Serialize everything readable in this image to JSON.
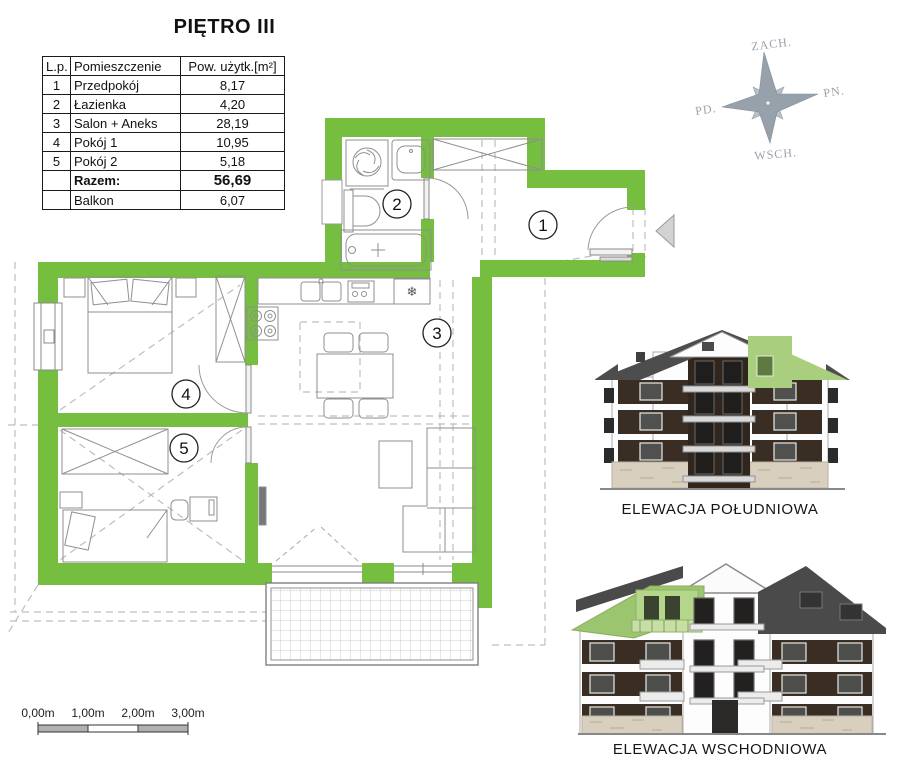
{
  "title": "PIĘTRO III",
  "table": {
    "headers": [
      "L.p.",
      "Pomieszczenie",
      "Pow. użytk.[m²]"
    ],
    "rows": [
      {
        "lp": "1",
        "name": "Przedpokój",
        "area": "8,17"
      },
      {
        "lp": "2",
        "name": "Łazienka",
        "area": "4,20"
      },
      {
        "lp": "3",
        "name": "Salon + Aneks",
        "area": "28,19"
      },
      {
        "lp": "4",
        "name": "Pokój 1",
        "area": "10,95"
      },
      {
        "lp": "5",
        "name": "Pokój 2",
        "area": "5,18"
      }
    ],
    "total": {
      "name": "Razem:",
      "area": "56,69"
    },
    "balcony": {
      "name": "Balkon",
      "area": "6,07"
    }
  },
  "compass": {
    "top": "ZACH.",
    "right": "PN.",
    "bottom": "WSCH.",
    "left": "PD."
  },
  "plan": {
    "room_numbers": [
      "1",
      "2",
      "3",
      "4",
      "5"
    ],
    "fridge_icon": "❄"
  },
  "elevations": {
    "south_caption": "ELEWACJA POŁUDNIOWA",
    "east_caption": "ELEWACJA WSCHODNIOWA"
  },
  "scale_bar": {
    "labels": [
      "0,00m",
      "1,00m",
      "2,00m",
      "3,00m"
    ]
  },
  "colors": {
    "wall_green": "#76BE3F",
    "highlight_green": "#A9CE7D"
  }
}
